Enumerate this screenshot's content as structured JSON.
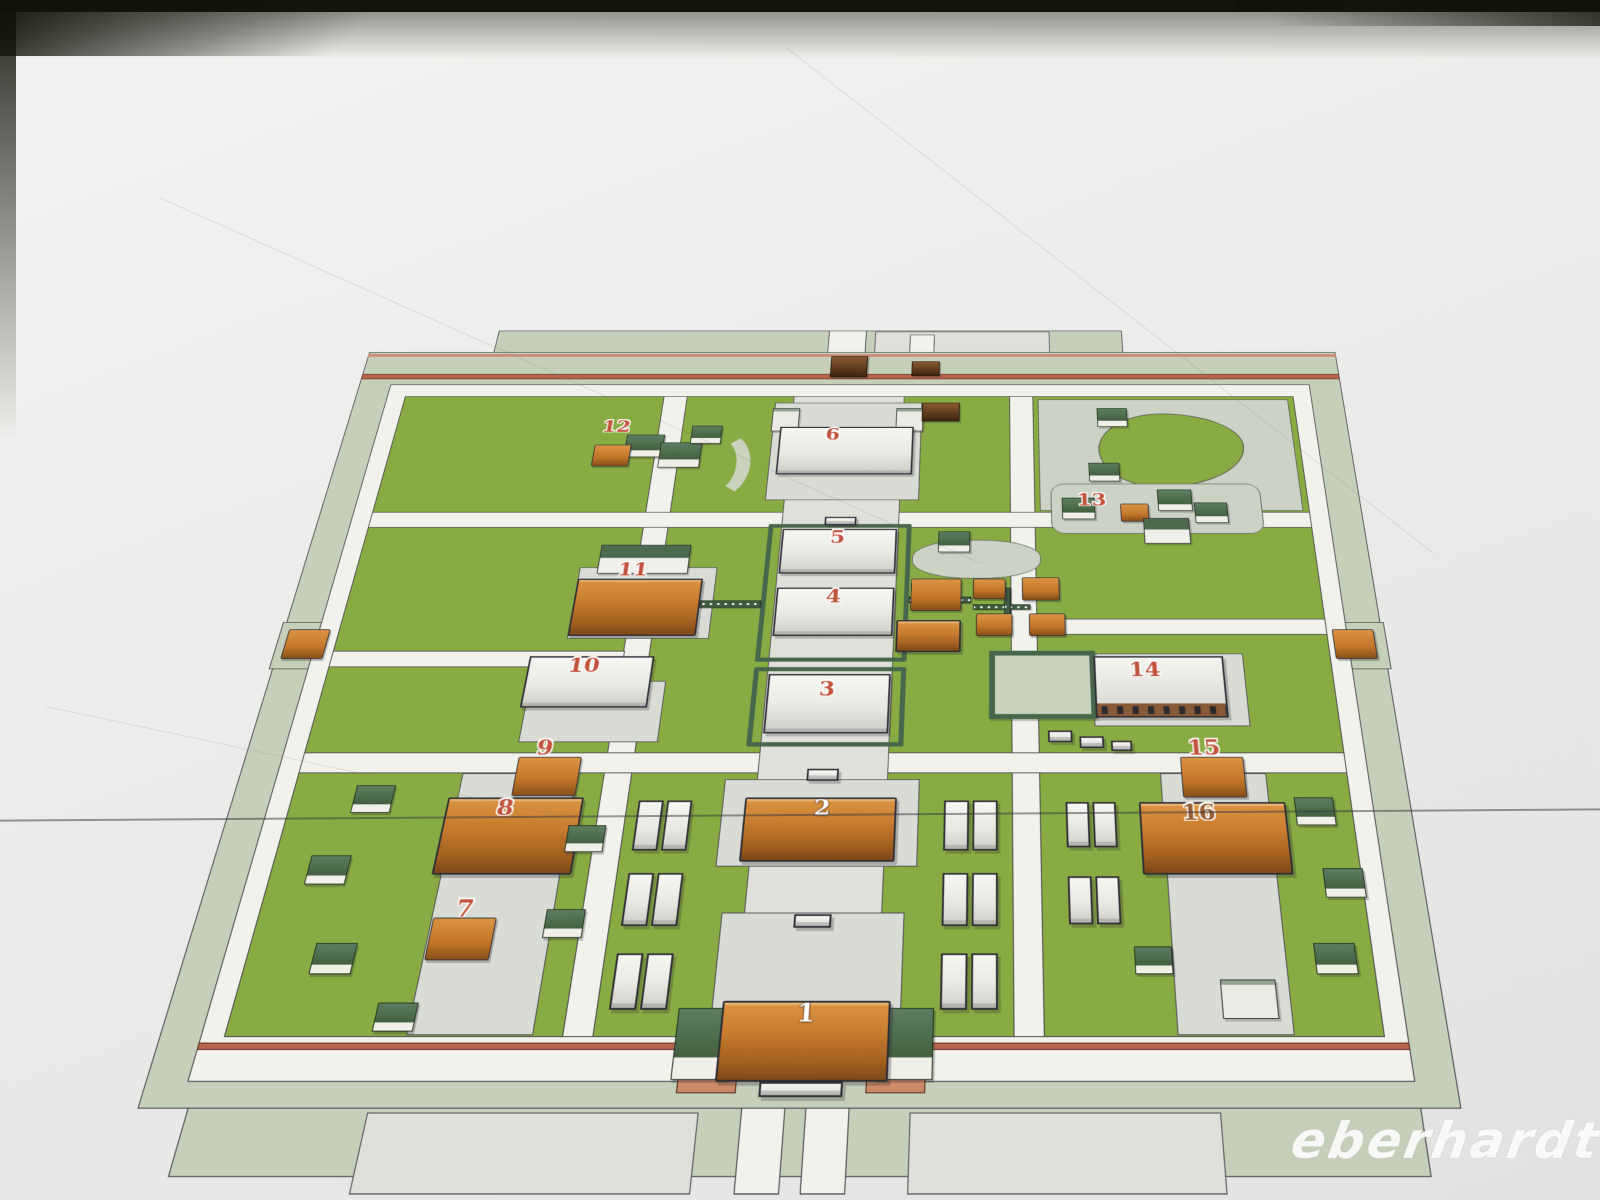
{
  "photo": {
    "watermark": "eberhardt"
  },
  "map": {
    "type": "isometric-site-plan",
    "markers": [
      {
        "number": "1"
      },
      {
        "number": "2"
      },
      {
        "number": "3"
      },
      {
        "number": "4"
      },
      {
        "number": "5"
      },
      {
        "number": "6"
      },
      {
        "number": "7"
      },
      {
        "number": "8"
      },
      {
        "number": "9"
      },
      {
        "number": "10"
      },
      {
        "number": "11"
      },
      {
        "number": "12"
      },
      {
        "number": "13"
      },
      {
        "number": "14"
      },
      {
        "number": "15"
      },
      {
        "number": "16"
      }
    ],
    "colors": {
      "grass": "#88ab40",
      "paving_sage": "#c6cfb8",
      "path_white": "#f2f2ec",
      "roof_orange": "#c97c2c",
      "roof_green": "#42603f",
      "wall_terracotta": "#b9664a",
      "building_white": "#ededе8",
      "label_red": "#c4513a",
      "label_white": "#ffffff",
      "watermark_white": "#ffffff"
    }
  }
}
